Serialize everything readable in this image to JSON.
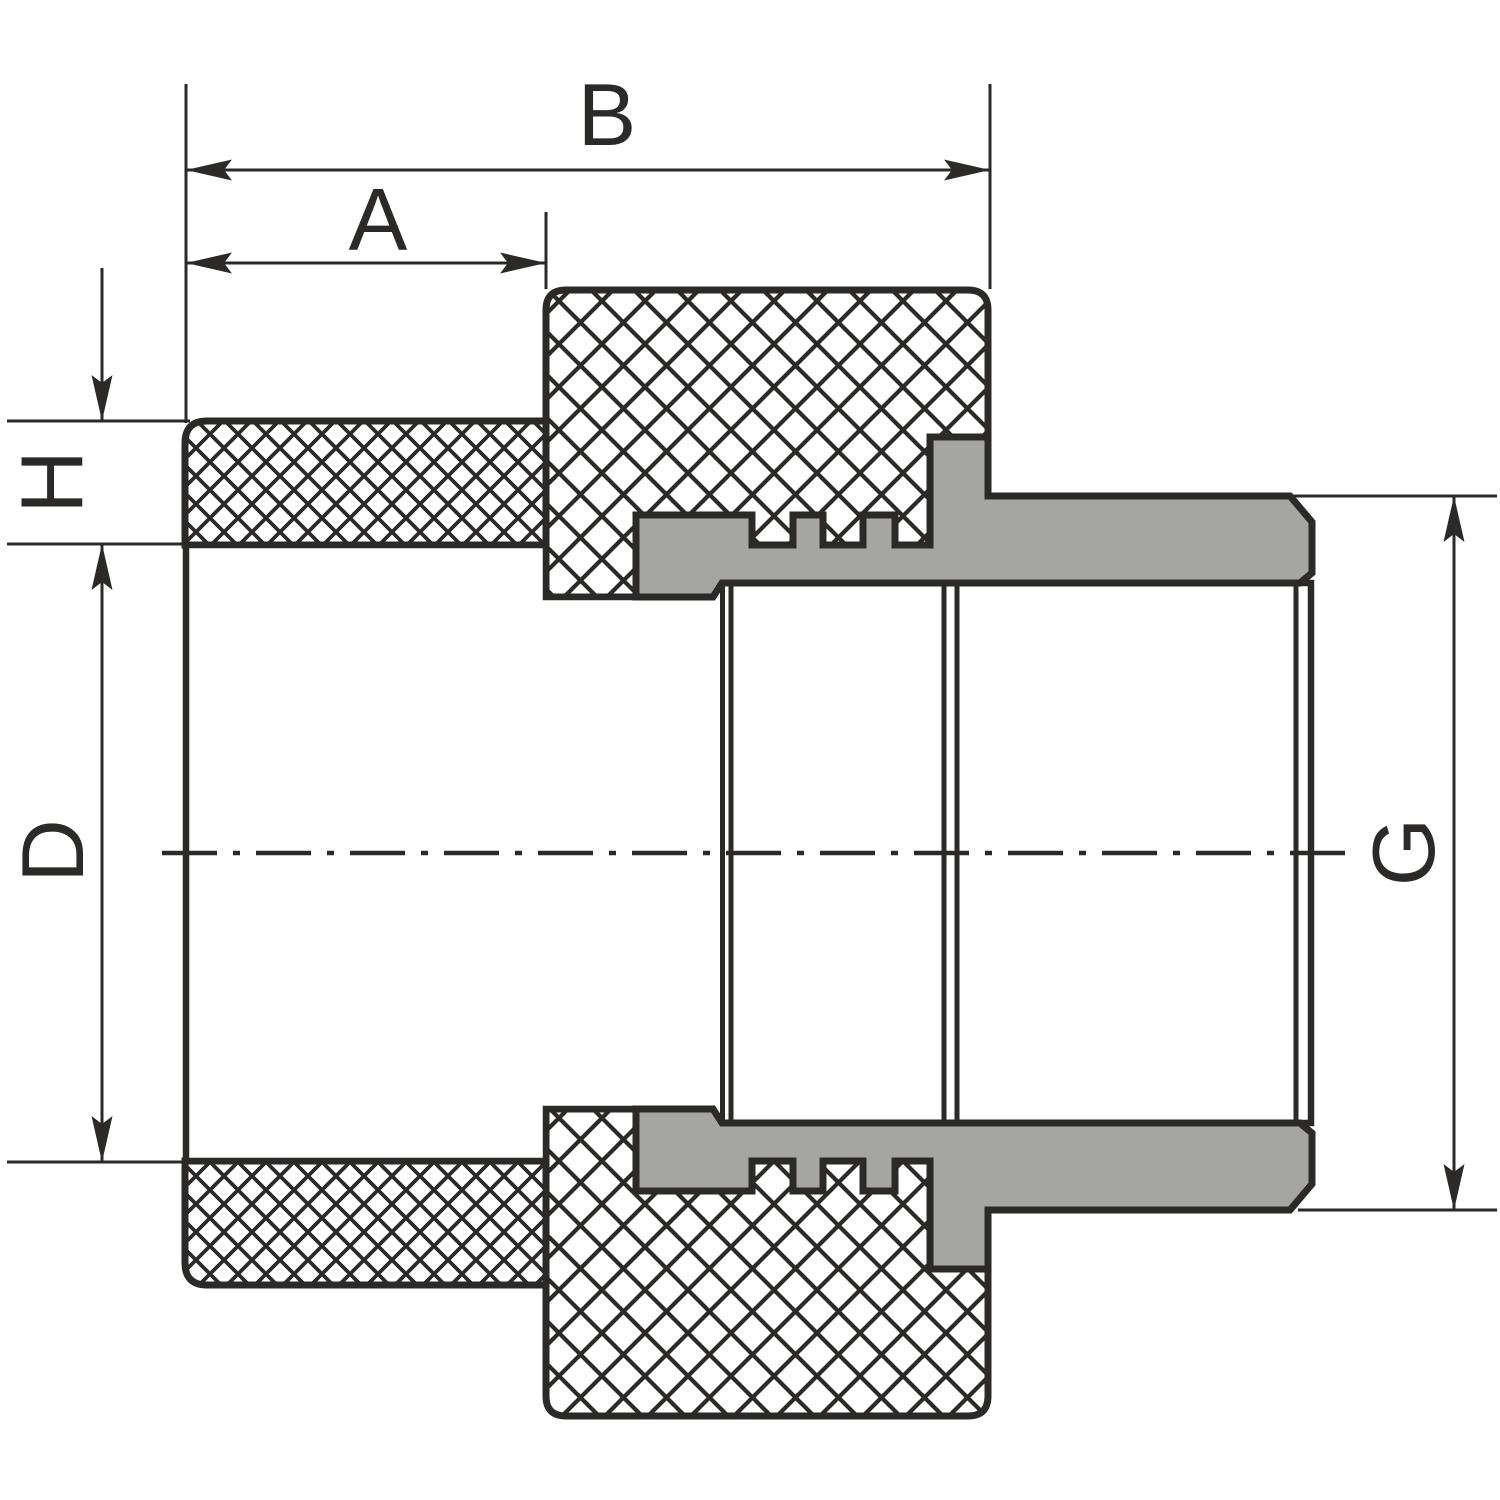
{
  "labels": {
    "A": "A",
    "B": "B",
    "D": "D",
    "G": "G",
    "H": "H"
  },
  "colors": {
    "line": "#2b2a29",
    "metal_fill": "#a5a5a4",
    "plastic_fill": "#ffffff",
    "background": "#ffffff"
  }
}
